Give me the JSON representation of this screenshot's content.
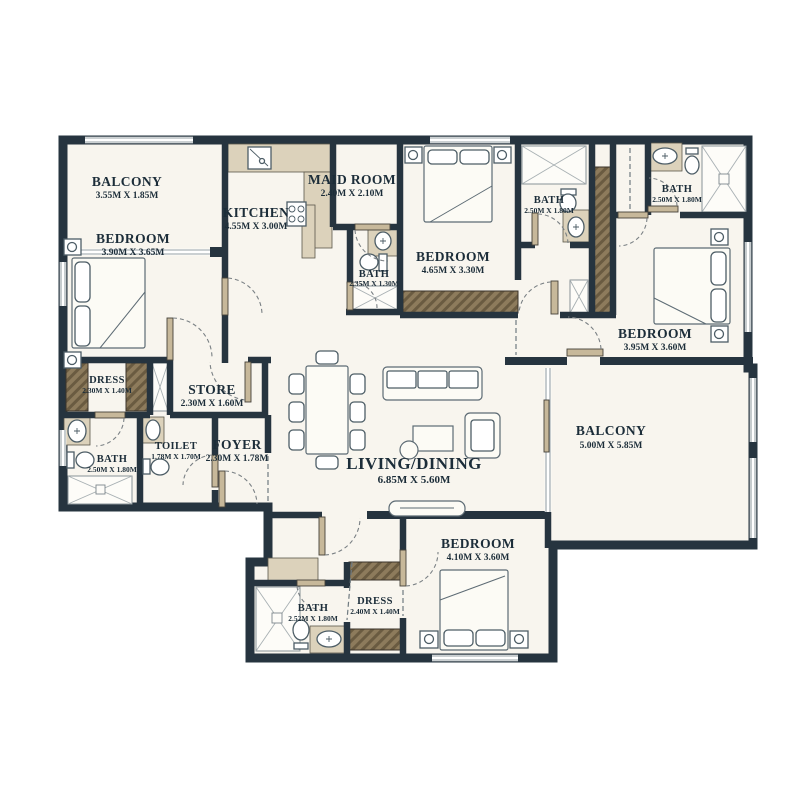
{
  "plan": {
    "type": "apartment-floor-plan",
    "rooms": [
      {
        "name": "BALCONY",
        "dims": "3.55M X 1.85M"
      },
      {
        "name": "BEDROOM",
        "dims": "3.90M X 3.65M"
      },
      {
        "name": "KITCHEN",
        "dims": "4.55M X 3.00M"
      },
      {
        "name": "MAID ROOM",
        "dims": "2.40M X 2.10M"
      },
      {
        "name": "BEDROOM",
        "dims": "4.65M X 3.30M"
      },
      {
        "name": "BATH",
        "dims": "2.50M X 1.80M"
      },
      {
        "name": "BATH",
        "dims": "2.50M X 1.80M"
      },
      {
        "name": "BEDROOM",
        "dims": "3.95M X 3.60M"
      },
      {
        "name": "BATH",
        "dims": "2.35M X 1.30M"
      },
      {
        "name": "DRESS",
        "dims": "2.30M X 1.40M"
      },
      {
        "name": "STORE",
        "dims": "2.30M X 1.60M"
      },
      {
        "name": "BATH",
        "dims": "2.50M X 1.80M"
      },
      {
        "name": "TOILET",
        "dims": "1.78M X 1.70M"
      },
      {
        "name": "FOYER",
        "dims": "2.30M X 1.78M"
      },
      {
        "name": "LIVING/DINING",
        "dims": "6.85M X 5.60M"
      },
      {
        "name": "BALCONY",
        "dims": "5.00M X 5.85M"
      },
      {
        "name": "BEDROOM",
        "dims": "4.10M X 3.60M"
      },
      {
        "name": "BATH",
        "dims": "2.52M X 1.80M"
      },
      {
        "name": "DRESS",
        "dims": "2.40M X 1.40M"
      }
    ],
    "colors": {
      "wall": "#26343f",
      "floor": "#f8f5ee",
      "counter_beige": "#dcd2bb",
      "wardrobe_brown": "#8d7b5c",
      "text": "#1c2d39",
      "page_background": "#ffffff"
    }
  }
}
